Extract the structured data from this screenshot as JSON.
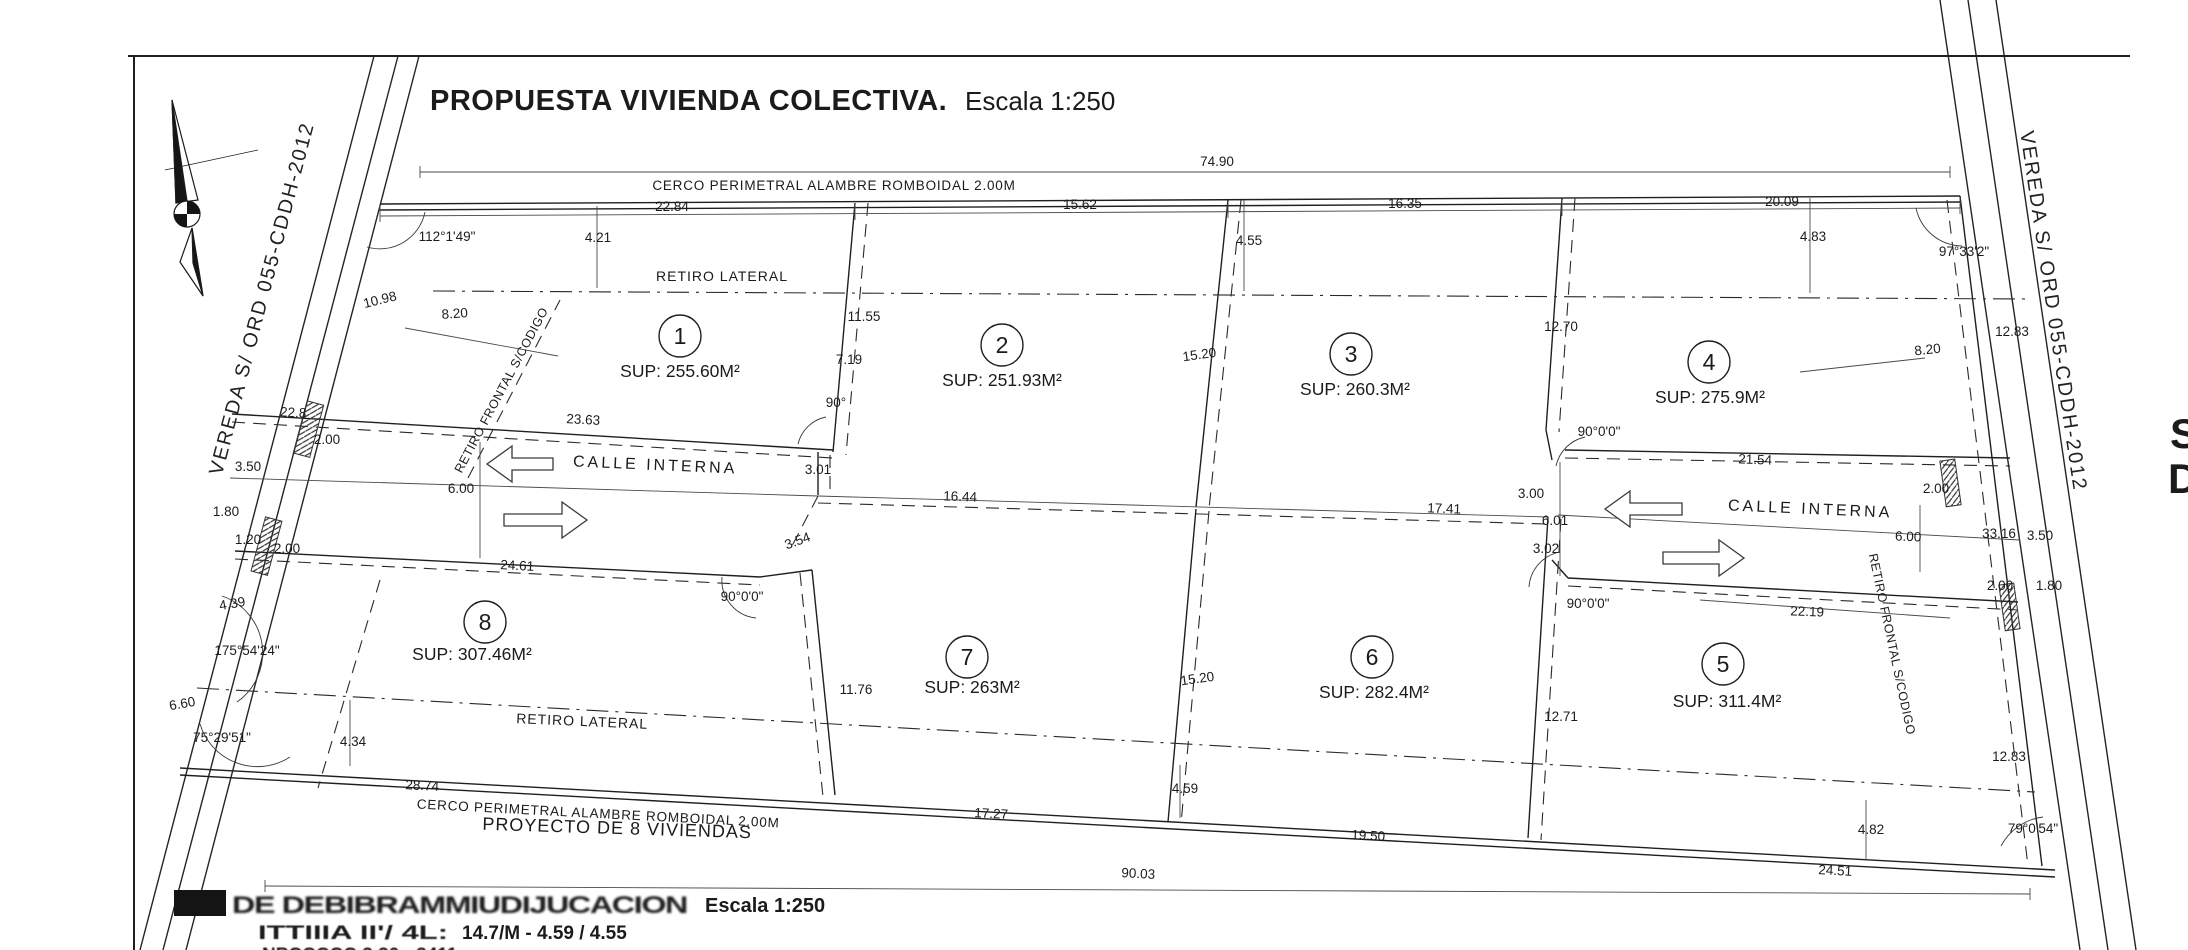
{
  "title": {
    "main": "PROPUESTA VIVIENDA COLECTIVA.",
    "scale": "Escala 1:250"
  },
  "streets": {
    "left_label": "VEREDA S/ ORD 055-CDDH-2012",
    "right_label": "VEREDA S/ ORD 055-CDDH-2012"
  },
  "fences": {
    "top": "CERCO PERIMETRAL ALAMBRE ROMBOIDAL 2.00M",
    "bottom": "CERCO PERIMETRAL ALAMBRE ROMBOIDAL 2.00M"
  },
  "setbacks": {
    "lateral_top": "RETIRO LATERAL",
    "lateral_bottom": "RETIRO LATERAL",
    "frontal_left": "RETIRO FRONTAL S/CODIGO",
    "frontal_right": "RETIRO FRONTAL S/CODIGO"
  },
  "internal_street": {
    "left": "CALLE INTERNA",
    "right": "CALLE INTERNA"
  },
  "project_label": "PROYECTO DE 8 VIVIENDAS",
  "edge_text": {
    "letter1": "S",
    "letter2": "D"
  },
  "bottom_block": {
    "illegible_title": "DE DEBIBRAMMIUDIJUCACION",
    "title_scale": "Escala 1:250",
    "line3_prefix": "ITTIIIA II'/ 4L:",
    "line3_values": "14.7/M -  4.59 /  4.55",
    "line4_partial": "NPCCCCC 3.30 - 3411"
  },
  "lots": [
    {
      "number": "1",
      "sup": "SUP: 255.60M²"
    },
    {
      "number": "2",
      "sup": "SUP: 251.93M²"
    },
    {
      "number": "3",
      "sup": "SUP: 260.3M²"
    },
    {
      "number": "4",
      "sup": "SUP: 275.9M²"
    },
    {
      "number": "5",
      "sup": "SUP: 311.4M²"
    },
    {
      "number": "6",
      "sup": "SUP: 282.4M²"
    },
    {
      "number": "7",
      "sup": "SUP: 263M²"
    },
    {
      "number": "8",
      "sup": "SUP: 307.46M²"
    }
  ],
  "dims": [
    {
      "t": "74.90",
      "x": 1217,
      "y": 166,
      "r": 0
    },
    {
      "t": "22.84",
      "x": 672,
      "y": 211,
      "r": 0
    },
    {
      "t": "15.62",
      "x": 1080,
      "y": 209,
      "r": 0
    },
    {
      "t": "16.35",
      "x": 1405,
      "y": 208,
      "r": 0
    },
    {
      "t": "20.09",
      "x": 1782,
      "y": 206,
      "r": 0
    },
    {
      "t": "112°1'49\"",
      "x": 447,
      "y": 241,
      "r": 0
    },
    {
      "t": "97°33'2\"",
      "x": 1964,
      "y": 256,
      "r": 0
    },
    {
      "t": "4.21",
      "x": 598,
      "y": 242,
      "r": 0
    },
    {
      "t": "4.55",
      "x": 1249,
      "y": 245,
      "r": 0
    },
    {
      "t": "4.83",
      "x": 1813,
      "y": 241,
      "r": 0
    },
    {
      "t": "10.98",
      "x": 381,
      "y": 304,
      "r": -14
    },
    {
      "t": "8.20",
      "x": 455,
      "y": 318,
      "r": -4
    },
    {
      "t": "11.55",
      "x": 864,
      "y": 321,
      "r": 0
    },
    {
      "t": "7.19",
      "x": 849,
      "y": 364,
      "r": 0
    },
    {
      "t": "90°",
      "x": 836,
      "y": 407,
      "r": 0
    },
    {
      "t": "15.20",
      "x": 1200,
      "y": 359,
      "r": -8
    },
    {
      "t": "12.70",
      "x": 1561,
      "y": 331,
      "r": 0
    },
    {
      "t": "12.83",
      "x": 2012,
      "y": 336,
      "r": 0
    },
    {
      "t": "8.20",
      "x": 1928,
      "y": 354,
      "r": -6
    },
    {
      "t": "23.63",
      "x": 583,
      "y": 424,
      "r": 3
    },
    {
      "t": "2.00",
      "x": 327,
      "y": 444,
      "r": 0
    },
    {
      "t": "22.8",
      "x": 293,
      "y": 417,
      "r": 3
    },
    {
      "t": "3.50",
      "x": 248,
      "y": 471,
      "r": 0
    },
    {
      "t": "1.80",
      "x": 226,
      "y": 516,
      "r": 0
    },
    {
      "t": "1.20",
      "x": 248,
      "y": 544,
      "r": 0
    },
    {
      "t": "2.00",
      "x": 287,
      "y": 553,
      "r": 0
    },
    {
      "t": "6.00",
      "x": 461,
      "y": 493,
      "r": 0
    },
    {
      "t": "3.01",
      "x": 818,
      "y": 474,
      "r": 0
    },
    {
      "t": "16.44",
      "x": 960,
      "y": 501,
      "r": 2
    },
    {
      "t": "3.54",
      "x": 799,
      "y": 545,
      "r": -20
    },
    {
      "t": "90°0'0\"",
      "x": 742,
      "y": 601,
      "r": 0
    },
    {
      "t": "24.61",
      "x": 517,
      "y": 570,
      "r": 3
    },
    {
      "t": "17.41",
      "x": 1444,
      "y": 513,
      "r": 2
    },
    {
      "t": "3.00",
      "x": 1531,
      "y": 498,
      "r": 0
    },
    {
      "t": "6.01",
      "x": 1555,
      "y": 525,
      "r": 0
    },
    {
      "t": "3.02",
      "x": 1546,
      "y": 553,
      "r": 0
    },
    {
      "t": "90°0'0\"",
      "x": 1599,
      "y": 436,
      "r": 0
    },
    {
      "t": "21.54",
      "x": 1755,
      "y": 464,
      "r": 2
    },
    {
      "t": "2.00",
      "x": 1936,
      "y": 493,
      "r": 0
    },
    {
      "t": "33.16",
      "x": 1999,
      "y": 538,
      "r": 0
    },
    {
      "t": "3.50",
      "x": 2040,
      "y": 540,
      "r": 0
    },
    {
      "t": "6.00",
      "x": 1908,
      "y": 541,
      "r": 2
    },
    {
      "t": "2.00",
      "x": 2000,
      "y": 590,
      "r": 0
    },
    {
      "t": "1.80",
      "x": 2049,
      "y": 590,
      "r": 0
    },
    {
      "t": "22.19",
      "x": 1807,
      "y": 616,
      "r": 2
    },
    {
      "t": "90°0'0\"",
      "x": 1588,
      "y": 608,
      "r": 0
    },
    {
      "t": "4.39",
      "x": 233,
      "y": 608,
      "r": -10
    },
    {
      "t": "175°54'24\"",
      "x": 247,
      "y": 655,
      "r": 0
    },
    {
      "t": "6.60",
      "x": 183,
      "y": 708,
      "r": -10
    },
    {
      "t": "75°29'51\"",
      "x": 222,
      "y": 742,
      "r": 0
    },
    {
      "t": "4.34",
      "x": 353,
      "y": 746,
      "r": 0
    },
    {
      "t": "11.76",
      "x": 856,
      "y": 694,
      "r": 0
    },
    {
      "t": "15.20",
      "x": 1198,
      "y": 683,
      "r": -8
    },
    {
      "t": "12.71",
      "x": 1561,
      "y": 721,
      "r": 0
    },
    {
      "t": "28.74",
      "x": 422,
      "y": 790,
      "r": 3
    },
    {
      "t": "4.59",
      "x": 1185,
      "y": 793,
      "r": 0
    },
    {
      "t": "17.27",
      "x": 991,
      "y": 818,
      "r": 3
    },
    {
      "t": "19.50",
      "x": 1368,
      "y": 840,
      "r": 3
    },
    {
      "t": "12.83",
      "x": 2009,
      "y": 761,
      "r": 0
    },
    {
      "t": "90.03",
      "x": 1138,
      "y": 878,
      "r": 3
    },
    {
      "t": "4.82",
      "x": 1871,
      "y": 834,
      "r": 0
    },
    {
      "t": "24.51",
      "x": 1835,
      "y": 875,
      "r": 3
    },
    {
      "t": "79°0'54\"",
      "x": 2033,
      "y": 833,
      "r": 0
    }
  ]
}
